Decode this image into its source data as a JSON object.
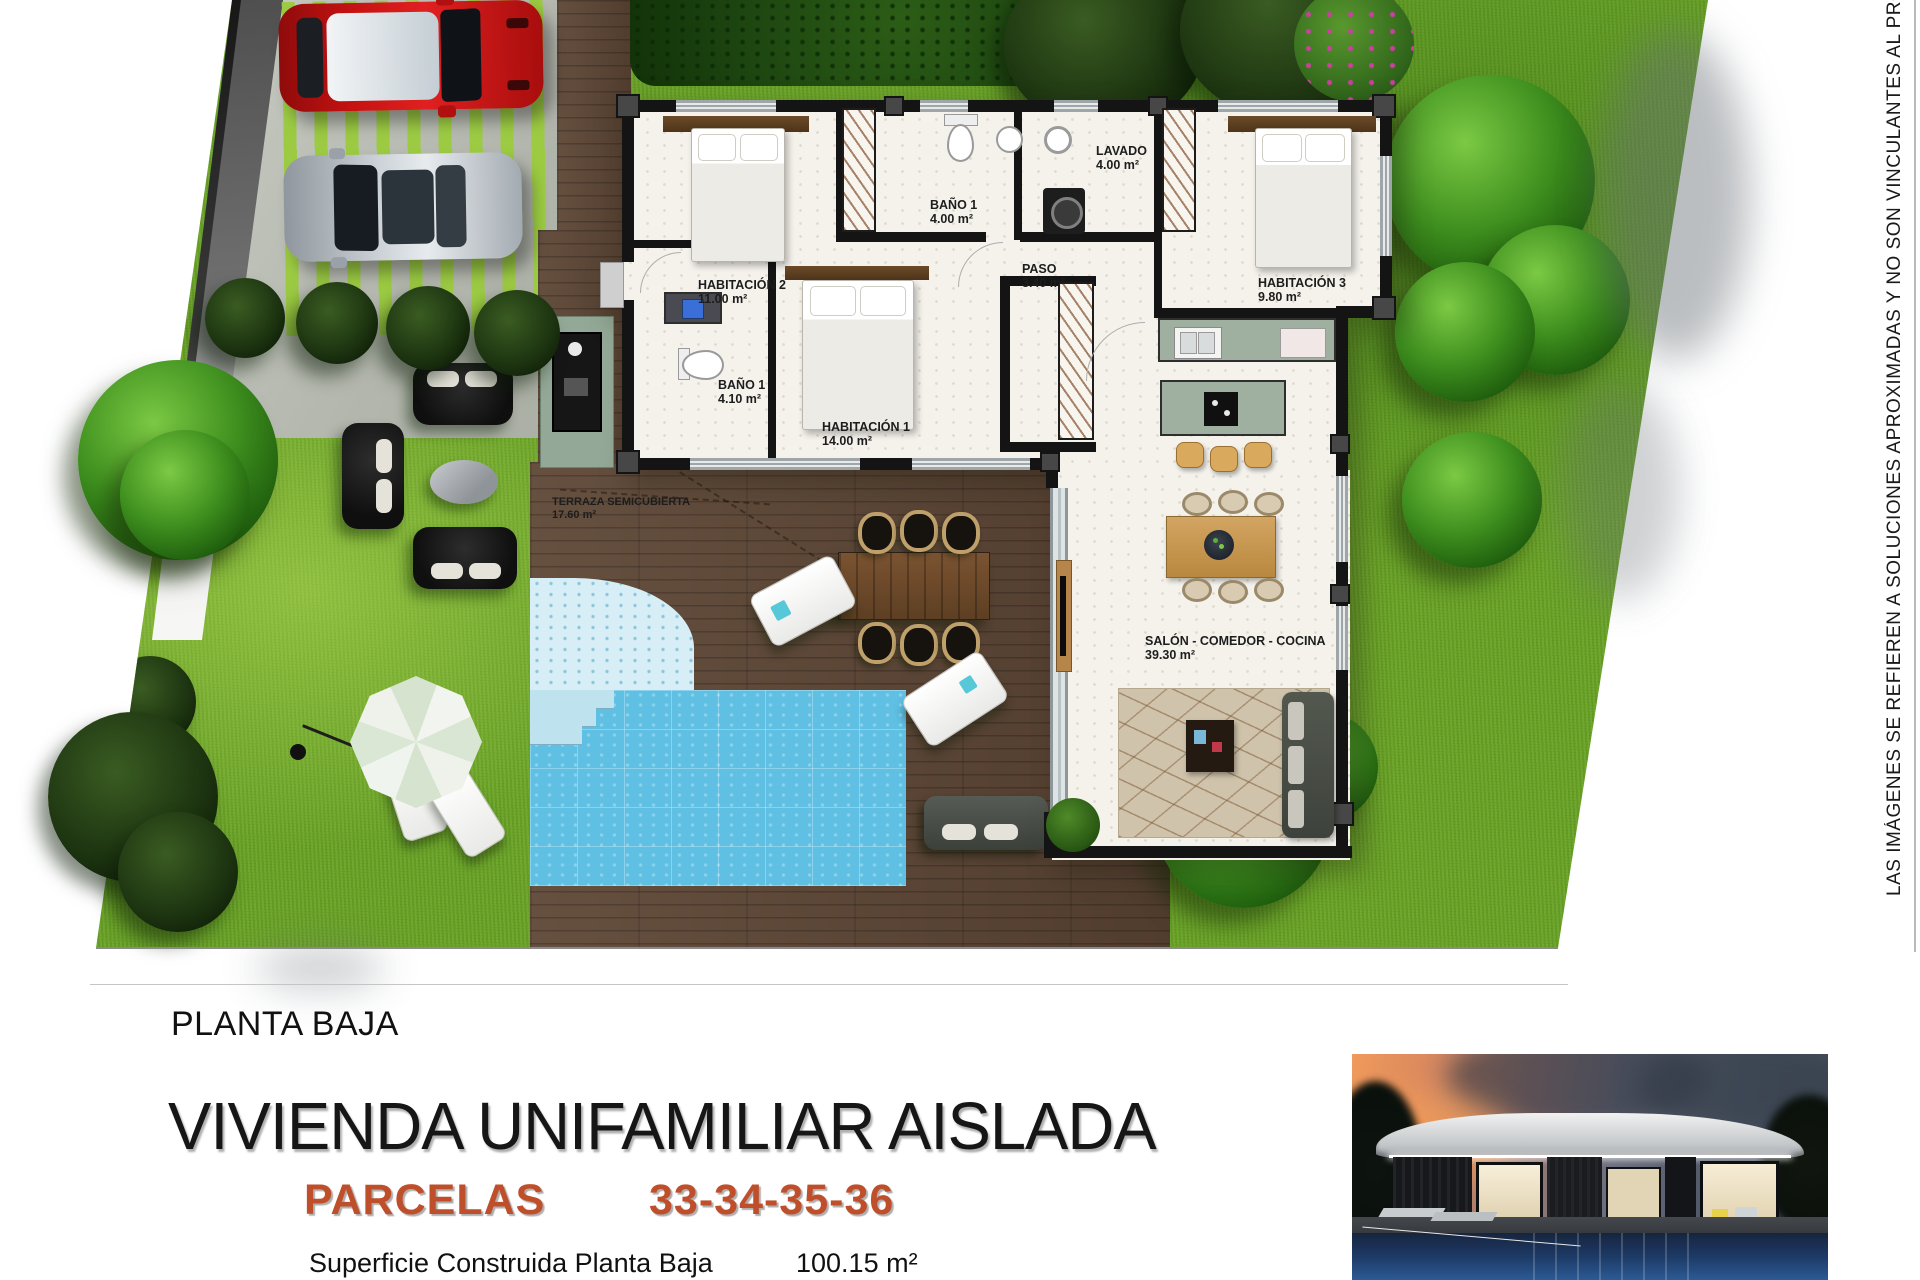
{
  "page": {
    "plan_label": "PLANTA BAJA",
    "title": "VIVIENDA UNIFAMILIAR AISLADA",
    "parcels_label": "PARCELAS",
    "parcels_numbers": "33-34-35-36",
    "surface_label": "Superficie Construida Planta Baja",
    "surface_value": "100.15 m²",
    "disclaimer_vertical": "LAS IMÁGENES SE REFIEREN A SOLUCIONES APROXIMADAS Y NO SON VINCULANTES AL PROYECTO"
  },
  "floor_plan": {
    "rooms": [
      {
        "name": "HABITACIÓN 2",
        "area": "11.00 m²"
      },
      {
        "name": "BAÑO 1",
        "area": "4.00 m²"
      },
      {
        "name": "LAVADO",
        "area": "4.00 m²"
      },
      {
        "name": "PASO",
        "area": "3.40 m²"
      },
      {
        "name": "HABITACIÓN 3",
        "area": "9.80 m²"
      },
      {
        "name": "BAÑO 1",
        "area": "4.10 m²"
      },
      {
        "name": "HABITACIÓN 1",
        "area": "14.00 m²"
      },
      {
        "name": "TERRAZA SEMICUBIERTA",
        "area": "17.60 m²"
      },
      {
        "name": "SALÓN - COMEDOR - COCINA",
        "area": "39.30 m²"
      }
    ]
  },
  "colors": {
    "grass": "#69a325",
    "deck": "#5c4534",
    "pool": "#5fc0e4",
    "pool-shallow": "#d8eef6",
    "wall": "#141414",
    "floor": "#f5f2ec",
    "accent": "#bf4f2b",
    "counter": "#9fb0a1",
    "car-red": "#c61212",
    "car-silver": "#ccd2d7"
  }
}
